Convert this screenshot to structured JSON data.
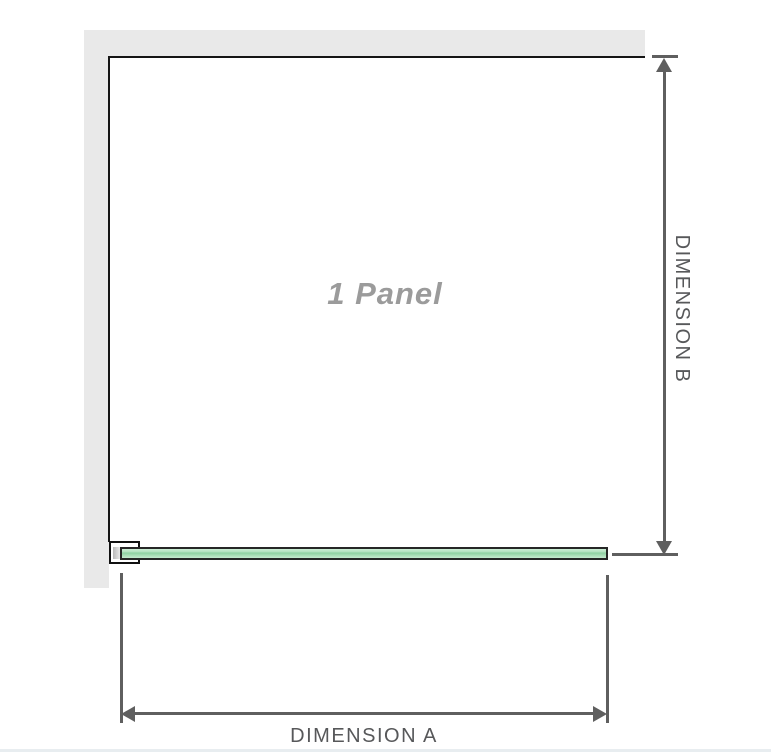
{
  "diagram": {
    "title": "shower-panel-dimension-diagram",
    "panel_label": "1 Panel",
    "dimension_a": {
      "label": "DIMENSION A",
      "orientation": "horizontal"
    },
    "dimension_b": {
      "label": "DIMENSION B",
      "orientation": "vertical"
    }
  },
  "colors": {
    "background": "#ffffff",
    "wall_gray": "#e9e9e9",
    "panel_outline": "#151515",
    "bracket_outline": "#111111",
    "glass_green": "#8fd1a2",
    "glass_green_light": "#cdeed6",
    "dimension_line": "#5f5f5f",
    "dimension_text": "#57585a",
    "panel_label_text": "#9b9b9b",
    "bottom_divider": "#e8edf0"
  }
}
